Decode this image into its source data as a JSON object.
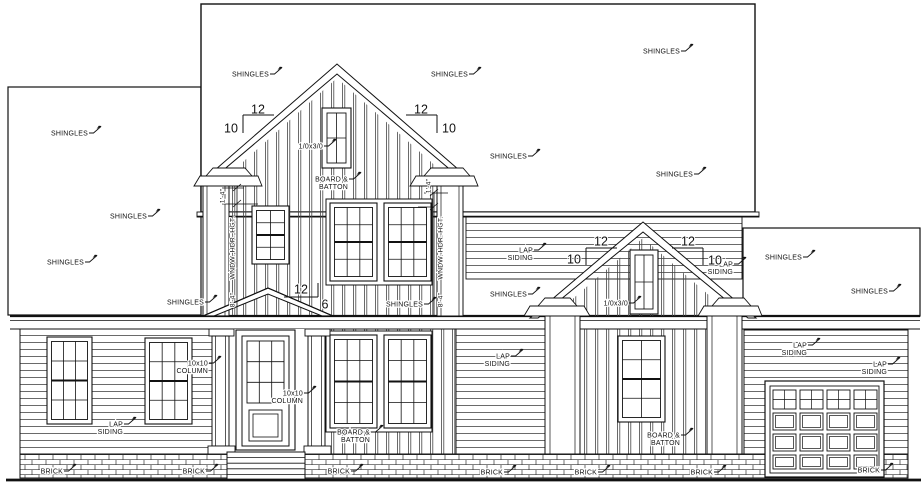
{
  "drawing": {
    "annotations": {
      "shingles": {
        "label": "SHINGLES",
        "positions": [
          [
            269,
            74
          ],
          [
            468,
            74
          ],
          [
            680,
            51
          ],
          [
            527,
            156
          ],
          [
            693,
            174
          ],
          [
            88,
            133
          ],
          [
            147,
            216
          ],
          [
            84,
            262
          ],
          [
            204,
            302
          ],
          [
            423,
            304
          ],
          [
            527,
            294
          ],
          [
            802,
            257
          ],
          [
            888,
            291
          ]
        ]
      },
      "lap_siding": {
        "label": [
          "LAP",
          "SIDING"
        ],
        "positions": [
          [
            123,
            424
          ],
          [
            533,
            250
          ],
          [
            733,
            264
          ],
          [
            510,
            356
          ],
          [
            807,
            345
          ],
          [
            887,
            364
          ]
        ]
      },
      "board_batton": {
        "label": [
          "BOARD &",
          "BATTON"
        ],
        "positions": [
          [
            348,
            179
          ],
          [
            370,
            432
          ],
          [
            680,
            435
          ]
        ]
      },
      "column_10x10": {
        "label": [
          "10x10",
          "COLUMN"
        ],
        "positions": [
          [
            208,
            363
          ],
          [
            303,
            393
          ]
        ]
      },
      "window_size": {
        "label": "1/0x3/0",
        "positions": [
          [
            323,
            146
          ],
          [
            628,
            303
          ]
        ]
      },
      "brick": {
        "label": "BRICK",
        "positions": [
          [
            63,
            471
          ],
          [
            205,
            471
          ],
          [
            350,
            471
          ],
          [
            503,
            472
          ],
          [
            597,
            472
          ],
          [
            713,
            472
          ],
          [
            880,
            470
          ]
        ]
      }
    },
    "pitch_markers": [
      {
        "run": "12",
        "rise": "10",
        "run_pos": [
          258,
          111
        ],
        "rise_pos": [
          231,
          130
        ],
        "hline": [
          243,
          115,
          274,
          115
        ],
        "vline": [
          243,
          115,
          243,
          133
        ]
      },
      {
        "run": "12",
        "rise": "10",
        "run_pos": [
          421,
          111
        ],
        "rise_pos": [
          449,
          130
        ],
        "hline": [
          406,
          115,
          437,
          115
        ],
        "vline": [
          437,
          115,
          437,
          133
        ]
      },
      {
        "run": "12",
        "rise": "10",
        "run_pos": [
          601,
          243
        ],
        "rise_pos": [
          574,
          261
        ],
        "hline": [
          586,
          248,
          617,
          248
        ],
        "vline": [
          586,
          248,
          586,
          265
        ]
      },
      {
        "run": "12",
        "rise": "10",
        "run_pos": [
          688,
          243
        ],
        "rise_pos": [
          715,
          262
        ],
        "hline": [
          672,
          248,
          703,
          248
        ],
        "vline": [
          703,
          248,
          703,
          265
        ]
      },
      {
        "run": "12",
        "rise": "6",
        "run_pos": [
          301,
          291
        ],
        "rise_pos": [
          325,
          306
        ],
        "hline": [
          284,
          297,
          318,
          297
        ],
        "vline": [
          318,
          283,
          318,
          297
        ]
      }
    ],
    "dimensions": [
      {
        "text": "1'-4\"",
        "pos": [
          222,
          196
        ],
        "rotate": -90
      },
      {
        "text": "WNDW. HDR. HGT.",
        "pos": [
          232,
          248
        ],
        "rotate": -90
      },
      {
        "text": "8'-4\"",
        "pos": [
          232,
          300
        ],
        "rotate": -90
      },
      {
        "text": "1'-4\"",
        "pos": [
          428,
          186
        ],
        "rotate": -90
      },
      {
        "text": "WNDW. HDR. HGT.",
        "pos": [
          440,
          248
        ],
        "rotate": -90
      },
      {
        "text": "8'-4\"",
        "pos": [
          440,
          300
        ],
        "rotate": -90
      }
    ]
  }
}
